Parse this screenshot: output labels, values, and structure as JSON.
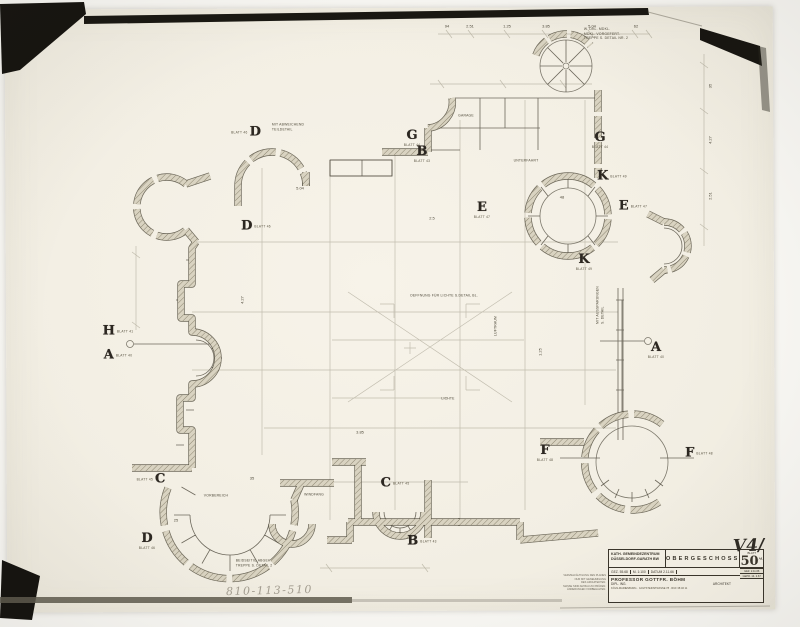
{
  "photo": {
    "background": "#f8f7f3",
    "sheet_color": "#f3efe4",
    "frame_dark": "#15130f",
    "pencil_color": "#97917f",
    "ink_color": "#4c473b",
    "wall_fill": "#d9d3c1"
  },
  "inscriptions": {
    "archive_number": "810-113-510",
    "revision": "V4/"
  },
  "title_block": {
    "project_line1": "KATH. GEMEINDEZENTRUM",
    "project_line2": "DÜSSELDORF-GARATH BW",
    "drawing_title": "OBERGESCHOSS",
    "row2": [
      "GEZ. 55.68",
      "M. 1:100",
      "DATUM 2.11.66"
    ],
    "architect_line1": "PROFESSOR GOTTFR. BÖHM",
    "architect_line2a": "DIPL. ING.",
    "architect_line2b": "ARCHITEKT",
    "address": "KÖLN-MARIENBURG · GOLTSTEINSTRASSE 78 · RUF 38 46 11",
    "blatt_label": "BLATT",
    "sheet_number": "50",
    "sheet_suffix": "AL",
    "stamp_rows": [
      "GEZ. 2.11.66",
      "GEPR. 14. 2.67"
    ],
    "legal_note": "VERVIELFÄLTIGUNG DES PLANES\nNUR MIT GENEHMIGUNG\nDES ARCHITEKTEN.\nMASSE SIND AM BAU ZU PRÜFEN.\nÄNDERUNGEN VORBEHALTEN."
  },
  "plan": {
    "markers": [
      {
        "letter": "D",
        "x": 246,
        "y": 132,
        "blatt": "BLATT 46",
        "lp": "l"
      },
      {
        "letter": "D",
        "x": 256,
        "y": 226,
        "blatt": "BLATT 46",
        "lp": "r"
      },
      {
        "letter": "G",
        "x": 412,
        "y": 138,
        "blatt": "BLATT 44",
        "lp": "b"
      },
      {
        "letter": "B",
        "x": 422,
        "y": 154,
        "blatt": "BLATT 43",
        "lp": "b"
      },
      {
        "letter": "G",
        "x": 600,
        "y": 140,
        "blatt": "BLATT 44",
        "lp": "b"
      },
      {
        "letter": "K",
        "x": 612,
        "y": 176,
        "blatt": "BLATT 49",
        "lp": "r"
      },
      {
        "letter": "E",
        "x": 482,
        "y": 210,
        "blatt": "BLATT 47",
        "lp": "b"
      },
      {
        "letter": "E",
        "x": 633,
        "y": 206,
        "blatt": "BLATT 47",
        "lp": "r"
      },
      {
        "letter": "K",
        "x": 584,
        "y": 262,
        "blatt": "BLATT 49",
        "lp": "b"
      },
      {
        "letter": "H",
        "x": 118,
        "y": 331,
        "blatt": "BLATT 41",
        "lp": "r"
      },
      {
        "letter": "A",
        "x": 118,
        "y": 355,
        "blatt": "BLATT 40",
        "lp": "r"
      },
      {
        "letter": "A",
        "x": 656,
        "y": 350,
        "blatt": "BLATT 40",
        "lp": "b"
      },
      {
        "letter": "F",
        "x": 545,
        "y": 453,
        "blatt": "BLATT 48",
        "lp": "b"
      },
      {
        "letter": "F",
        "x": 699,
        "y": 453,
        "blatt": "BLATT 48",
        "lp": "r"
      },
      {
        "letter": "C",
        "x": 151,
        "y": 479,
        "blatt": "BLATT 45",
        "lp": "l"
      },
      {
        "letter": "C",
        "x": 395,
        "y": 483,
        "blatt": "BLATT 45",
        "lp": "r"
      },
      {
        "letter": "B",
        "x": 422,
        "y": 541,
        "blatt": "BLATT 43",
        "lp": "r"
      },
      {
        "letter": "D",
        "x": 147,
        "y": 541,
        "blatt": "BLATT 46",
        "lp": "b"
      }
    ],
    "notes": [
      {
        "t": "MIT ABWEICHEND\nTEILDETAIL",
        "x": 288,
        "y": 127
      },
      {
        "t": "W. DKL. MDKL.\nMDKL. VORGEFERT.\nTREPPE S. DETAIL NR. 2",
        "x": 606,
        "y": 34
      },
      {
        "t": "GARAGE",
        "x": 466,
        "y": 116
      },
      {
        "t": "UNTERFAHRT",
        "x": 526,
        "y": 161
      },
      {
        "t": "OEFFNUNG FÜR LICHTE S.DETAIL BL.",
        "x": 444,
        "y": 296
      },
      {
        "t": "LUFTRAUM",
        "x": 496,
        "y": 326,
        "rot": -90
      },
      {
        "t": "LICHTE",
        "x": 448,
        "y": 399
      },
      {
        "t": "WINDFANG",
        "x": 314,
        "y": 495
      },
      {
        "t": "VORBEREICH",
        "x": 216,
        "y": 496
      },
      {
        "t": "BEIDSEITIG ABGEH.\nTREPPE S. DETAIL 2",
        "x": 254,
        "y": 563
      },
      {
        "t": "MIT AUSSPARUNGEN\nS. DETAIL",
        "x": 600,
        "y": 305,
        "rot": -90
      }
    ],
    "dims": [
      {
        "t": "94",
        "x": 447,
        "y": 26
      },
      {
        "t": "2.51",
        "x": 470,
        "y": 26
      },
      {
        "t": "1.25",
        "x": 507,
        "y": 26
      },
      {
        "t": "3.85",
        "x": 546,
        "y": 26
      },
      {
        "t": "5.04",
        "x": 592,
        "y": 26
      },
      {
        "t": "62",
        "x": 636,
        "y": 26
      },
      {
        "t": "35",
        "x": 710,
        "y": 86,
        "rot": -90
      },
      {
        "t": "4.27",
        "x": 710,
        "y": 140,
        "rot": -90
      },
      {
        "t": "2.51",
        "x": 710,
        "y": 196,
        "rot": -90
      },
      {
        "t": "48",
        "x": 562,
        "y": 197
      },
      {
        "t": "5.04",
        "x": 300,
        "y": 188
      },
      {
        "t": "4.27",
        "x": 242,
        "y": 300,
        "rot": -90
      },
      {
        "t": "3.85",
        "x": 360,
        "y": 432
      },
      {
        "t": "2.5",
        "x": 432,
        "y": 218
      },
      {
        "t": "25",
        "x": 176,
        "y": 520
      },
      {
        "t": "35",
        "x": 252,
        "y": 478
      },
      {
        "t": "1.25",
        "x": 540,
        "y": 352,
        "rot": -90
      }
    ]
  }
}
